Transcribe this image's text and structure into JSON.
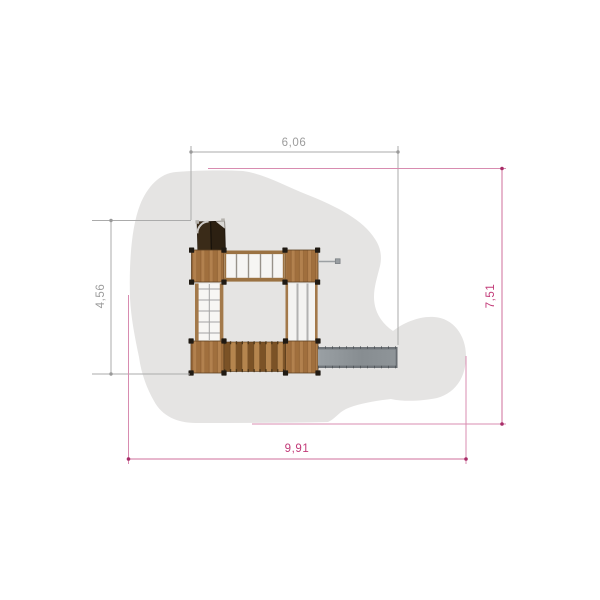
{
  "drawing": {
    "title": "playground-structure-plan-view",
    "dimensions": {
      "top_width": "6,06",
      "left_height": "4,56",
      "right_height": "7,51",
      "bottom_width": "9,91"
    },
    "colors": {
      "background": "#ffffff",
      "safety_zone": "#e5e4e3",
      "dimension_structure": "#9c9c9c",
      "dimension_safety_zone": "#c23a78",
      "dimension_safety_zone_line": "#cf6f9b",
      "wood_light": "#b5854e",
      "wood_dark": "#7b5226",
      "roof_dark": "#2c2012",
      "slide_gray": "#8d9296",
      "post_black": "#201a13"
    }
  }
}
